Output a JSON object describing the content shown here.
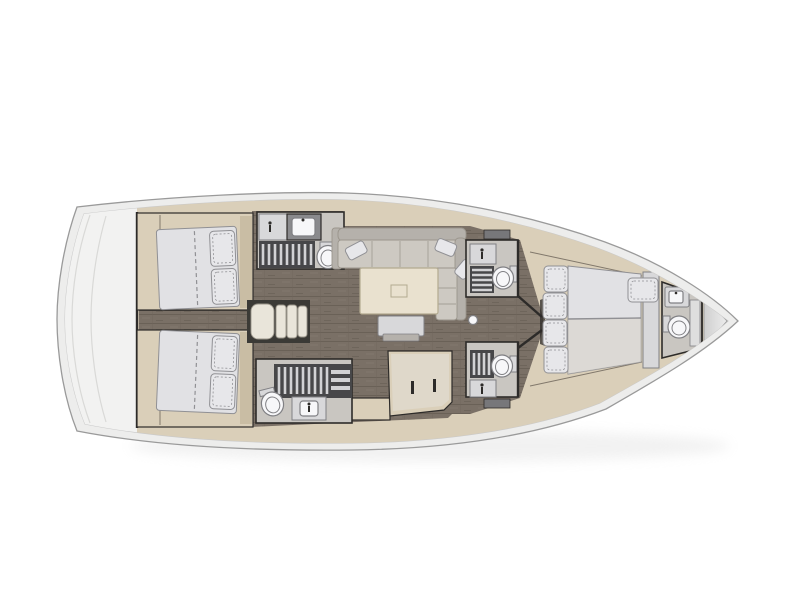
{
  "scene": {
    "subject": "sailing-yacht-interior-floor-plan",
    "view": "top-down",
    "bow_direction": "right",
    "visible_text": ""
  },
  "colors": {
    "canvas": "#ffffff",
    "hull_band": "#ededec",
    "hull_line": "#9a9a9a",
    "deck_fill": "#ffffff",
    "deck_line": "#c9c9c9",
    "platform": "#f2f2f1",
    "platform_line": "#d9d9d7",
    "wall": "#2d2b29",
    "cabinetry": "#dacfb9",
    "cabinetry_shade": "#c9bda4",
    "floor": "#7a7066",
    "floor_line": "#6a6157",
    "head_floor": "#c9c6c1",
    "grate_bg": "#474749",
    "grate_slat": "#d2d2d4",
    "fixture": "#f7f7f9",
    "fixture_line": "#808084",
    "counter_dark": "#8a8a8d",
    "unit_gray": "#d8d8da",
    "mattress": "#e1e1e4",
    "mattress_line": "#909094",
    "quilt": "#e7e7ea",
    "sofa": "#cdc9c2",
    "sofa_back": "#b5b1ab",
    "sofa_line": "#9a958c",
    "table": "#e9e1cf",
    "table_line": "#b3aa90",
    "steps": "#e9e5da",
    "steps_edge": "#9a958a",
    "steps_well": "#3b3a36",
    "shadow": "#d8d8d8",
    "bow_locker_light": "#ececec",
    "bow_locker_dark": "#cfcfcf"
  },
  "depicted_features": {
    "hull": "hull outline, bow pointing right",
    "stern_platform": "rounded transom / aft platform",
    "aft_cabin_port": "double-berth cabin, top left",
    "aft_cabin_starboard": "double-berth cabin, bottom left",
    "companionway_steps": "four-tread entry stairs between aft cabins",
    "head_aft_port": "wet room: sink counter, shower grating, toilet",
    "head_aft_starboard": "wet room: shower grating, toilet, sink",
    "saloon": "U-shaped settee, cushions, saloon table, movable stool",
    "galley": "L-shaped galley counter with locker handles",
    "head_mid_port": "en-suite: vanity, grating, toilet",
    "head_mid_starboard": "en-suite: vanity, grating, toilet",
    "mast_post": "mast compression post",
    "forward_cabin": "owner's island berth with pillow blocks and side bench",
    "bow_head": "forepeak wet room: sink and toilet",
    "anchor_locker": "bow anchor locker"
  }
}
